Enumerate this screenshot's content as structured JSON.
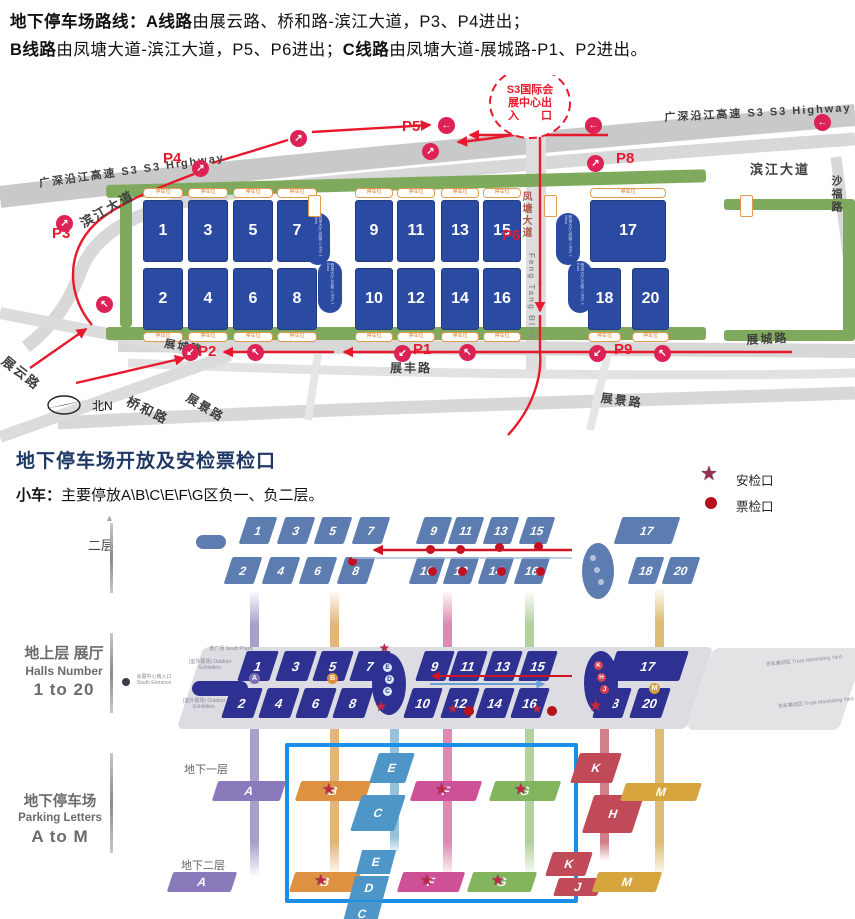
{
  "header": {
    "line1": [
      {
        "text": "地下停车场路线：",
        "bold": true
      },
      {
        "text": "A线路",
        "bold": true
      },
      {
        "text": "由展云路、桥和路-滨江大道，P3、P4进出；",
        "bold": false
      }
    ],
    "line2": [
      {
        "text": "B线路",
        "bold": true
      },
      {
        "text": "由凤塘大道-滨江大道，P5、P6进出；",
        "bold": false
      },
      {
        "text": "C线路",
        "bold": true
      },
      {
        "text": "由凤塘大道-展城路-P1、P2进出。",
        "bold": false
      }
    ]
  },
  "map": {
    "entrance_circle_lines": [
      "S3国际会",
      "展中心出",
      "入　　口"
    ],
    "compass": "北N",
    "capacity_label": "停车位",
    "halls": [
      1,
      2,
      3,
      4,
      5,
      6,
      7,
      8,
      9,
      10,
      11,
      12,
      13,
      14,
      15,
      16,
      17,
      18,
      19,
      20
    ],
    "road_labels": {
      "s3_left": "广深沿江高速 S3  S3 Highway",
      "s3_right": "广深沿江高速 S3  S3 Highway",
      "binjiang_left": "滨江大道",
      "binjiang_right": "滨江大道",
      "shafu": "沙福路",
      "fengtang_cn": "凤塘大道",
      "fengtang_en": "Feng Tang Blvd",
      "zhanyun": "展云路",
      "qiaohe": "桥和路",
      "zhancheng_left": "展城路",
      "zhancheng_right": "展城路",
      "zhanfeng": "展丰路",
      "zhanjing_left": "展景路",
      "zhanjing_center": "展景路"
    },
    "p_labels": [
      {
        "id": "p1",
        "text": "P1"
      },
      {
        "id": "p2",
        "text": "P2"
      },
      {
        "id": "p3",
        "text": "P3"
      },
      {
        "id": "p4",
        "text": "P4"
      },
      {
        "id": "p5",
        "text": "P5"
      },
      {
        "id": "p6",
        "text": "P6"
      },
      {
        "id": "p8",
        "text": "P8"
      },
      {
        "id": "p9",
        "text": "P9"
      }
    ],
    "lobbies": [
      "登录大厅1西侧 Lobby 1 West",
      "登录大厅1东侧 Lobby 1 East",
      "登录大厅2西侧 Lobby 2 West",
      "登录大厅2东侧 Lobby 2 East"
    ]
  },
  "section": {
    "title": "地下停车场开放及安检票检口",
    "note_label": "小车：",
    "note_text": "主要停放A\\B\\C\\E\\F\\G区负一、负二层。",
    "legend": [
      {
        "icon": "star",
        "label": "安检口"
      },
      {
        "icon": "dot",
        "label": "票检口"
      }
    ]
  },
  "diagram": {
    "floor2_label": "二层",
    "ground_label_cn": "地上层 展厅",
    "ground_label_en1": "Halls Number",
    "ground_label_en2": "1 to 20",
    "parking_label_cn": "地下停车场",
    "parking_label_en1": "Parking Letters",
    "parking_label_en2": "A to M",
    "b1_label": "地下一层",
    "b2_label": "地下二层",
    "south_plaza": "南广场 South Plaza",
    "outdoor": "(室外展场) Outdoor Exhibition",
    "south_entrance": "会展中心南入口 South Entrance",
    "truck_yard": "货车集结区 Truck Marshaling Yard",
    "lobby1_dots": [
      "E",
      "D",
      "C"
    ],
    "lobby2_dots": [
      "K",
      "H",
      "J"
    ],
    "aisle_dots": [
      {
        "letter": "A",
        "color": "#7d6fb6"
      },
      {
        "letter": "B",
        "color": "#dd8f3e"
      },
      {
        "letter": "M",
        "color": "#d2a340"
      }
    ],
    "b1_zones": [
      {
        "id": "A",
        "color": "#8a7abc",
        "star": false
      },
      {
        "id": "B",
        "color": "#de9140",
        "star": true
      },
      {
        "id": "E",
        "color": "#4e96c8",
        "star": false
      },
      {
        "id": "C",
        "color": "#4e96c8",
        "star": false
      },
      {
        "id": "F",
        "color": "#ce5097",
        "star": true
      },
      {
        "id": "G",
        "color": "#83b55e",
        "star": true
      },
      {
        "id": "K",
        "color": "#c14a58",
        "star": false
      },
      {
        "id": "H",
        "color": "#c14a58",
        "star": false
      },
      {
        "id": "M",
        "color": "#d6a53e",
        "star": false
      }
    ],
    "b2_zones": [
      {
        "id": "A",
        "color": "#8a7abc",
        "star": false
      },
      {
        "id": "B",
        "color": "#de9140",
        "star": true
      },
      {
        "id": "F",
        "color": "#ce5097",
        "star": true
      },
      {
        "id": "G",
        "color": "#83b55e",
        "star": true
      },
      {
        "id": "K",
        "color": "#c14a58",
        "star": false
      },
      {
        "id": "J",
        "color": "#c14a58",
        "star": false
      },
      {
        "id": "M",
        "color": "#d6a53e",
        "star": false
      }
    ],
    "b2_strip_letters": [
      "E",
      "D",
      "C"
    ]
  },
  "colors": {
    "route_red": "#e8192c",
    "marker_pink": "#dd2255",
    "hall_blue": "#2b4aa1",
    "ground_navy": "#2e3192",
    "floor2_blue": "#5d7cb0",
    "box_blue": "#1b8ee8",
    "star_red": "#c22741",
    "dot_red": "#b5121b",
    "green": "#7fa95c",
    "title_navy": "#1f3864"
  }
}
